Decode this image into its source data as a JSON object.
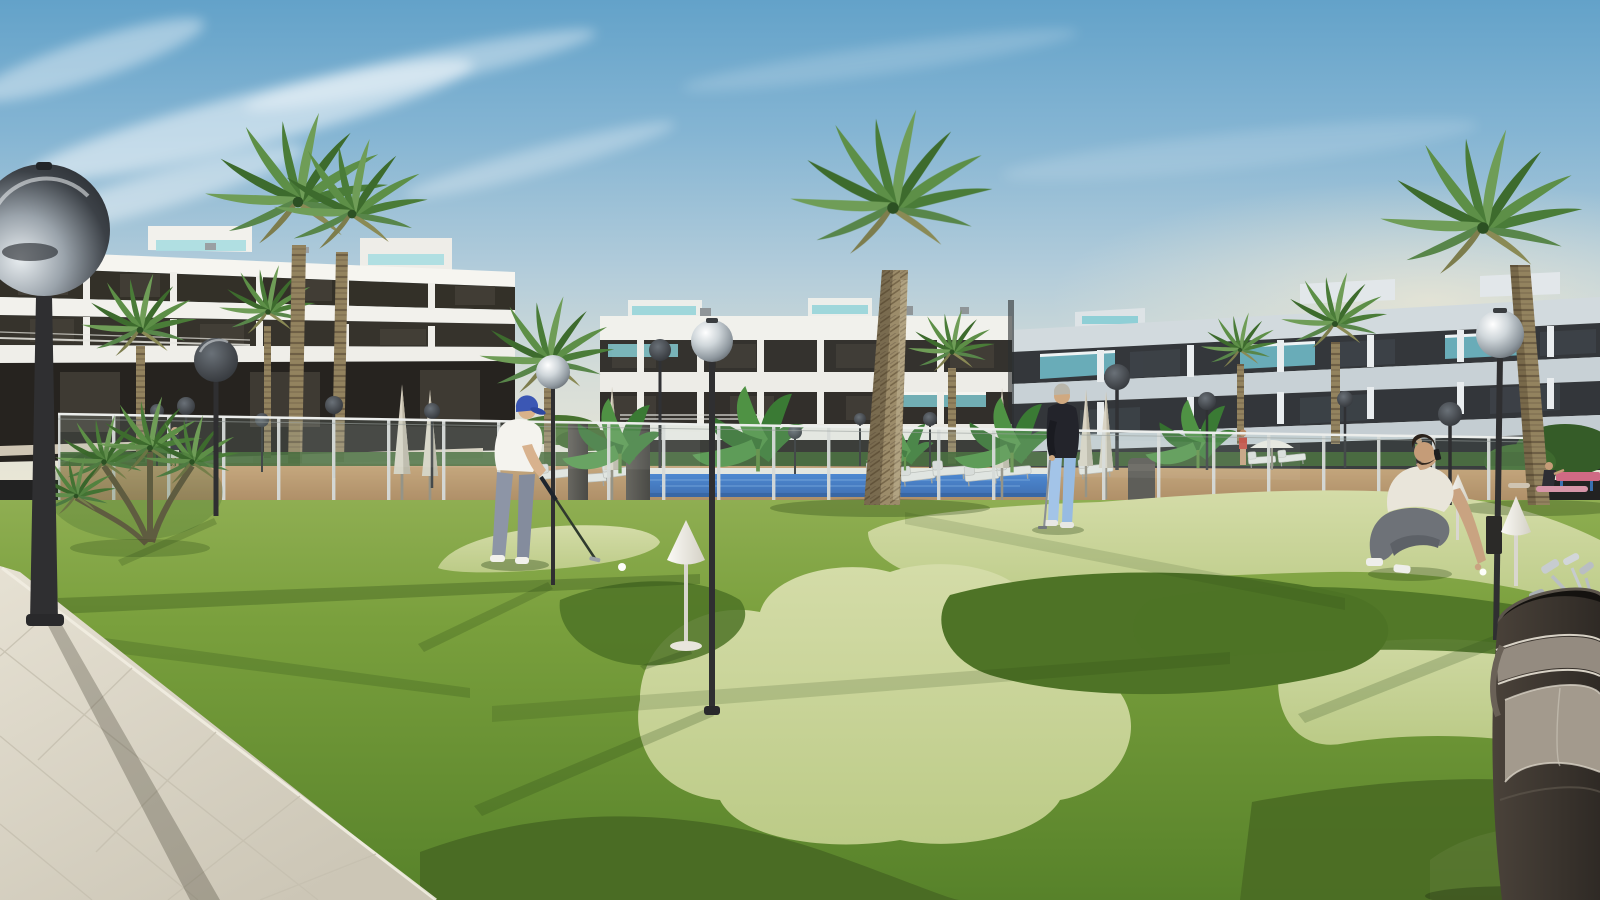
{
  "scene": {
    "title": "Residential complex with putting green – architectural render",
    "setting": "Sunny day, modern white apartment blocks around a landscaped mini-golf lawn with pool",
    "sky": {
      "top_color": "#63a2c9",
      "horizon_color": "#e9e6d6",
      "clouds": "wispy cirrus upper left"
    },
    "objects": [
      "three white apartment buildings with dark window bands and teal glass balconies",
      "tall fan palms and banana plants",
      "spherical-globe street lamps",
      "glass pool fence with swimming pool, sun loungers and closed parasols",
      "two-tone putting green with clover-shaped light patches",
      "white cone hole markers",
      "tiled beige walkway lower left",
      "golf bag with clubs lower right",
      "dark outdoor shower pillars",
      "grey litter bin"
    ],
    "people": [
      {
        "name": "golfer-putting",
        "clothing": "white polo, blue cap, grey trousers, white shoes"
      },
      {
        "name": "man-standing-with-putter",
        "clothing": "dark sweater, light blue trousers, grey hair"
      },
      {
        "name": "man-crouching-placing-ball",
        "clothing": "white t-shirt, grey trousers, white sneakers"
      },
      {
        "name": "distant-walker",
        "clothing": "dark top, white shorts"
      },
      {
        "name": "woman-at-fence",
        "clothing": "red swimwear"
      },
      {
        "name": "people-relaxing-right-lawn",
        "clothing": "dark top / pink mat"
      }
    ],
    "colors": {
      "grass": "#749c38",
      "putting_green": "#c9d39b",
      "grass_shadow": "#4e7326",
      "pool_water": "#2f6fc0",
      "pavement": "#ded9cb",
      "palm_trunk": "#8d7c60",
      "building_white": "#f5f4ef",
      "building_right": "#d2dade",
      "window_band": "#34322e",
      "teal_glass": "#7cc4cc",
      "lamp_pole": "#303134",
      "deck": "#bf9567",
      "golf_bag": "#3f3a35",
      "parasol": "#d9d3c3"
    }
  }
}
